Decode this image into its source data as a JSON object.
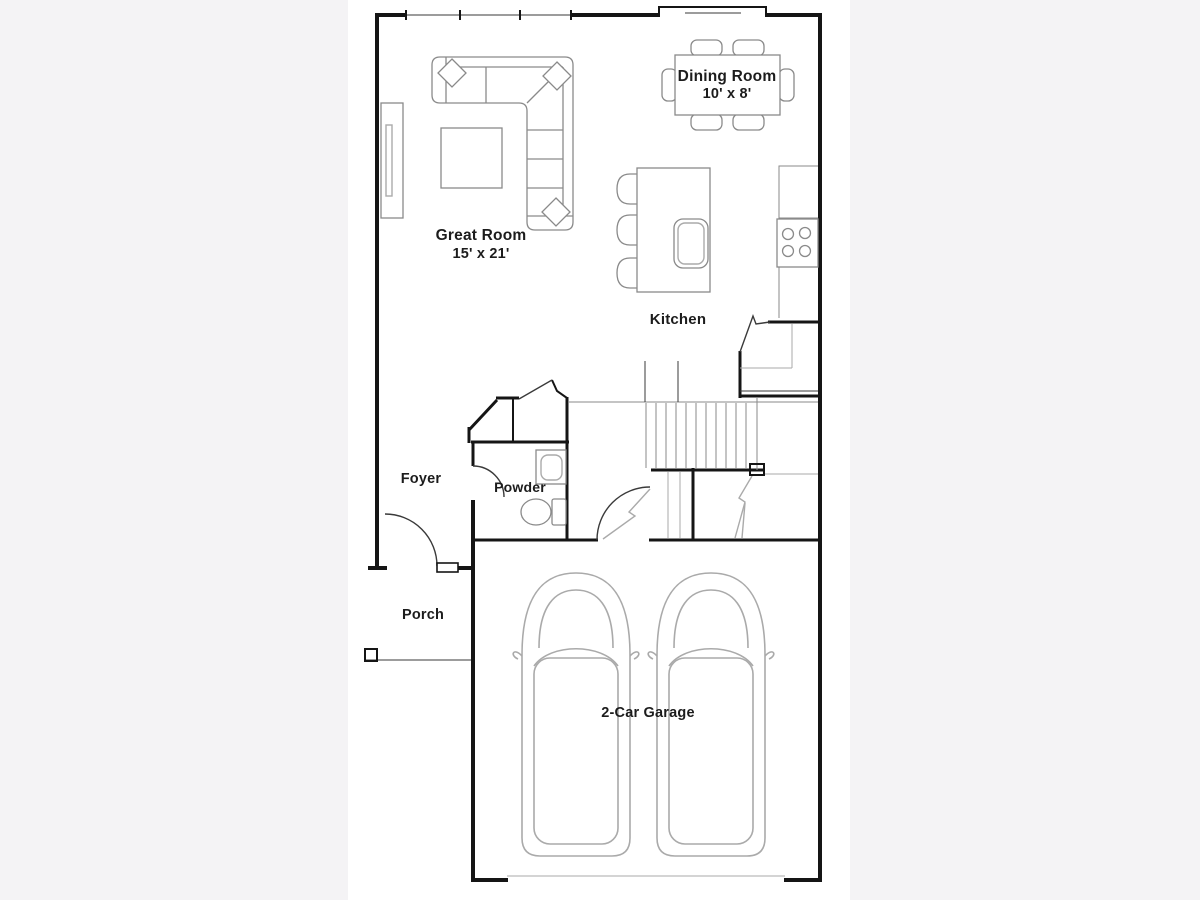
{
  "plan": {
    "rooms": {
      "dining": {
        "label": "Dining Room",
        "dimensions": "10' x 8'"
      },
      "great": {
        "label": "Great Room",
        "dimensions": "15' x 21'"
      },
      "kitchen": {
        "label": "Kitchen"
      },
      "foyer": {
        "label": "Foyer"
      },
      "powder": {
        "label": "Powder"
      },
      "porch": {
        "label": "Porch"
      },
      "garage": {
        "label": "2-Car Garage"
      }
    },
    "colors": {
      "page_background": "#f4f3f5",
      "canvas_background": "#ffffff",
      "wall": "#151515",
      "furniture": "#8a8a8a",
      "light_lines": "#aaaaaa",
      "text": "#1c1c1c"
    }
  }
}
